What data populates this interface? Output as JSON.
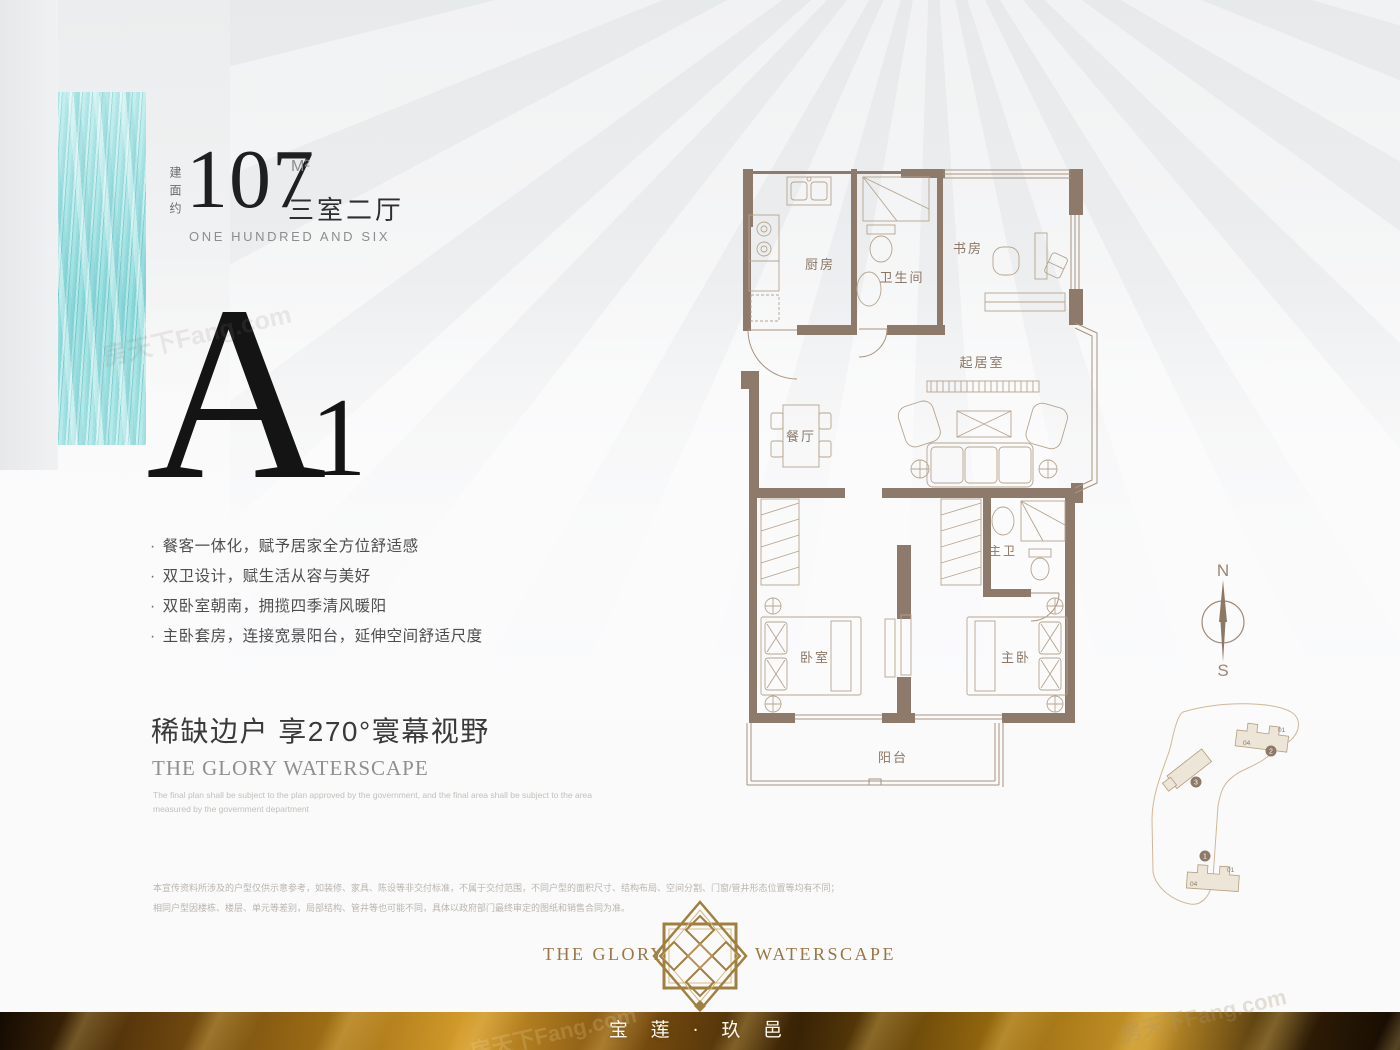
{
  "bullet": "·",
  "area": {
    "prefix": "建面约",
    "number": "107",
    "unit": "M²",
    "type": "三室二厅",
    "english": "ONE HUNDRED AND SIX"
  },
  "unit_code": {
    "letter": "A",
    "index": "1"
  },
  "features": [
    "餐客一体化，赋予居家全方位舒适感",
    "双卫设计，赋生活从容与美好",
    "双卧室朝南，拥揽四季清风暖阳",
    "主卧套房，连接宽景阳台，延伸空间舒适尺度"
  ],
  "headline": "稀缺边户 享270°寰幕视野",
  "sub_brand": {
    "title": "THE GLORY WATERSCAPE",
    "disclaimer_line1": "The final plan shall be subject to the plan approved by the government, and the final area shall be subject to the area",
    "disclaimer_line2": "measured by the government department"
  },
  "disclaimer": {
    "line1": "本宣传资料所涉及的户型仅供示意参考，如装修、家具、陈设等非交付标准，不属于交付范围，不同户型的面积尺寸、结构布局、空间分割、门窗/管井形态位置等均有不同；",
    "line2": "相同户型因楼栋、楼层、单元等差别，局部结构、管井等也可能不同，具体以政府部门最终审定的图纸和销售合同为准。"
  },
  "floorplan": {
    "rooms": {
      "kitchen": "厨房",
      "bathroom": "卫生间",
      "study": "书房",
      "living": "起居室",
      "dining": "餐厅",
      "master_bath": "主卫",
      "bedroom": "卧室",
      "master_bedroom": "主卧",
      "balcony": "阳台"
    }
  },
  "compass": {
    "north": "N",
    "south": "S"
  },
  "siteplan": {
    "building_1": "1",
    "building_2": "2",
    "building_3": "3",
    "unit_01": "01",
    "unit_04": "04"
  },
  "footer": {
    "brand_left": "THE GLORY",
    "brand_right": "WATERSCAPE",
    "project_name": "宝 莲 · 玖 邑"
  },
  "watermark": "房天下Fang.com",
  "colors": {
    "accent_teal": "#9adfe0",
    "wall_brown": "#8d7a6b",
    "gold": "#a08040",
    "bar_gold": "#a06f16"
  }
}
